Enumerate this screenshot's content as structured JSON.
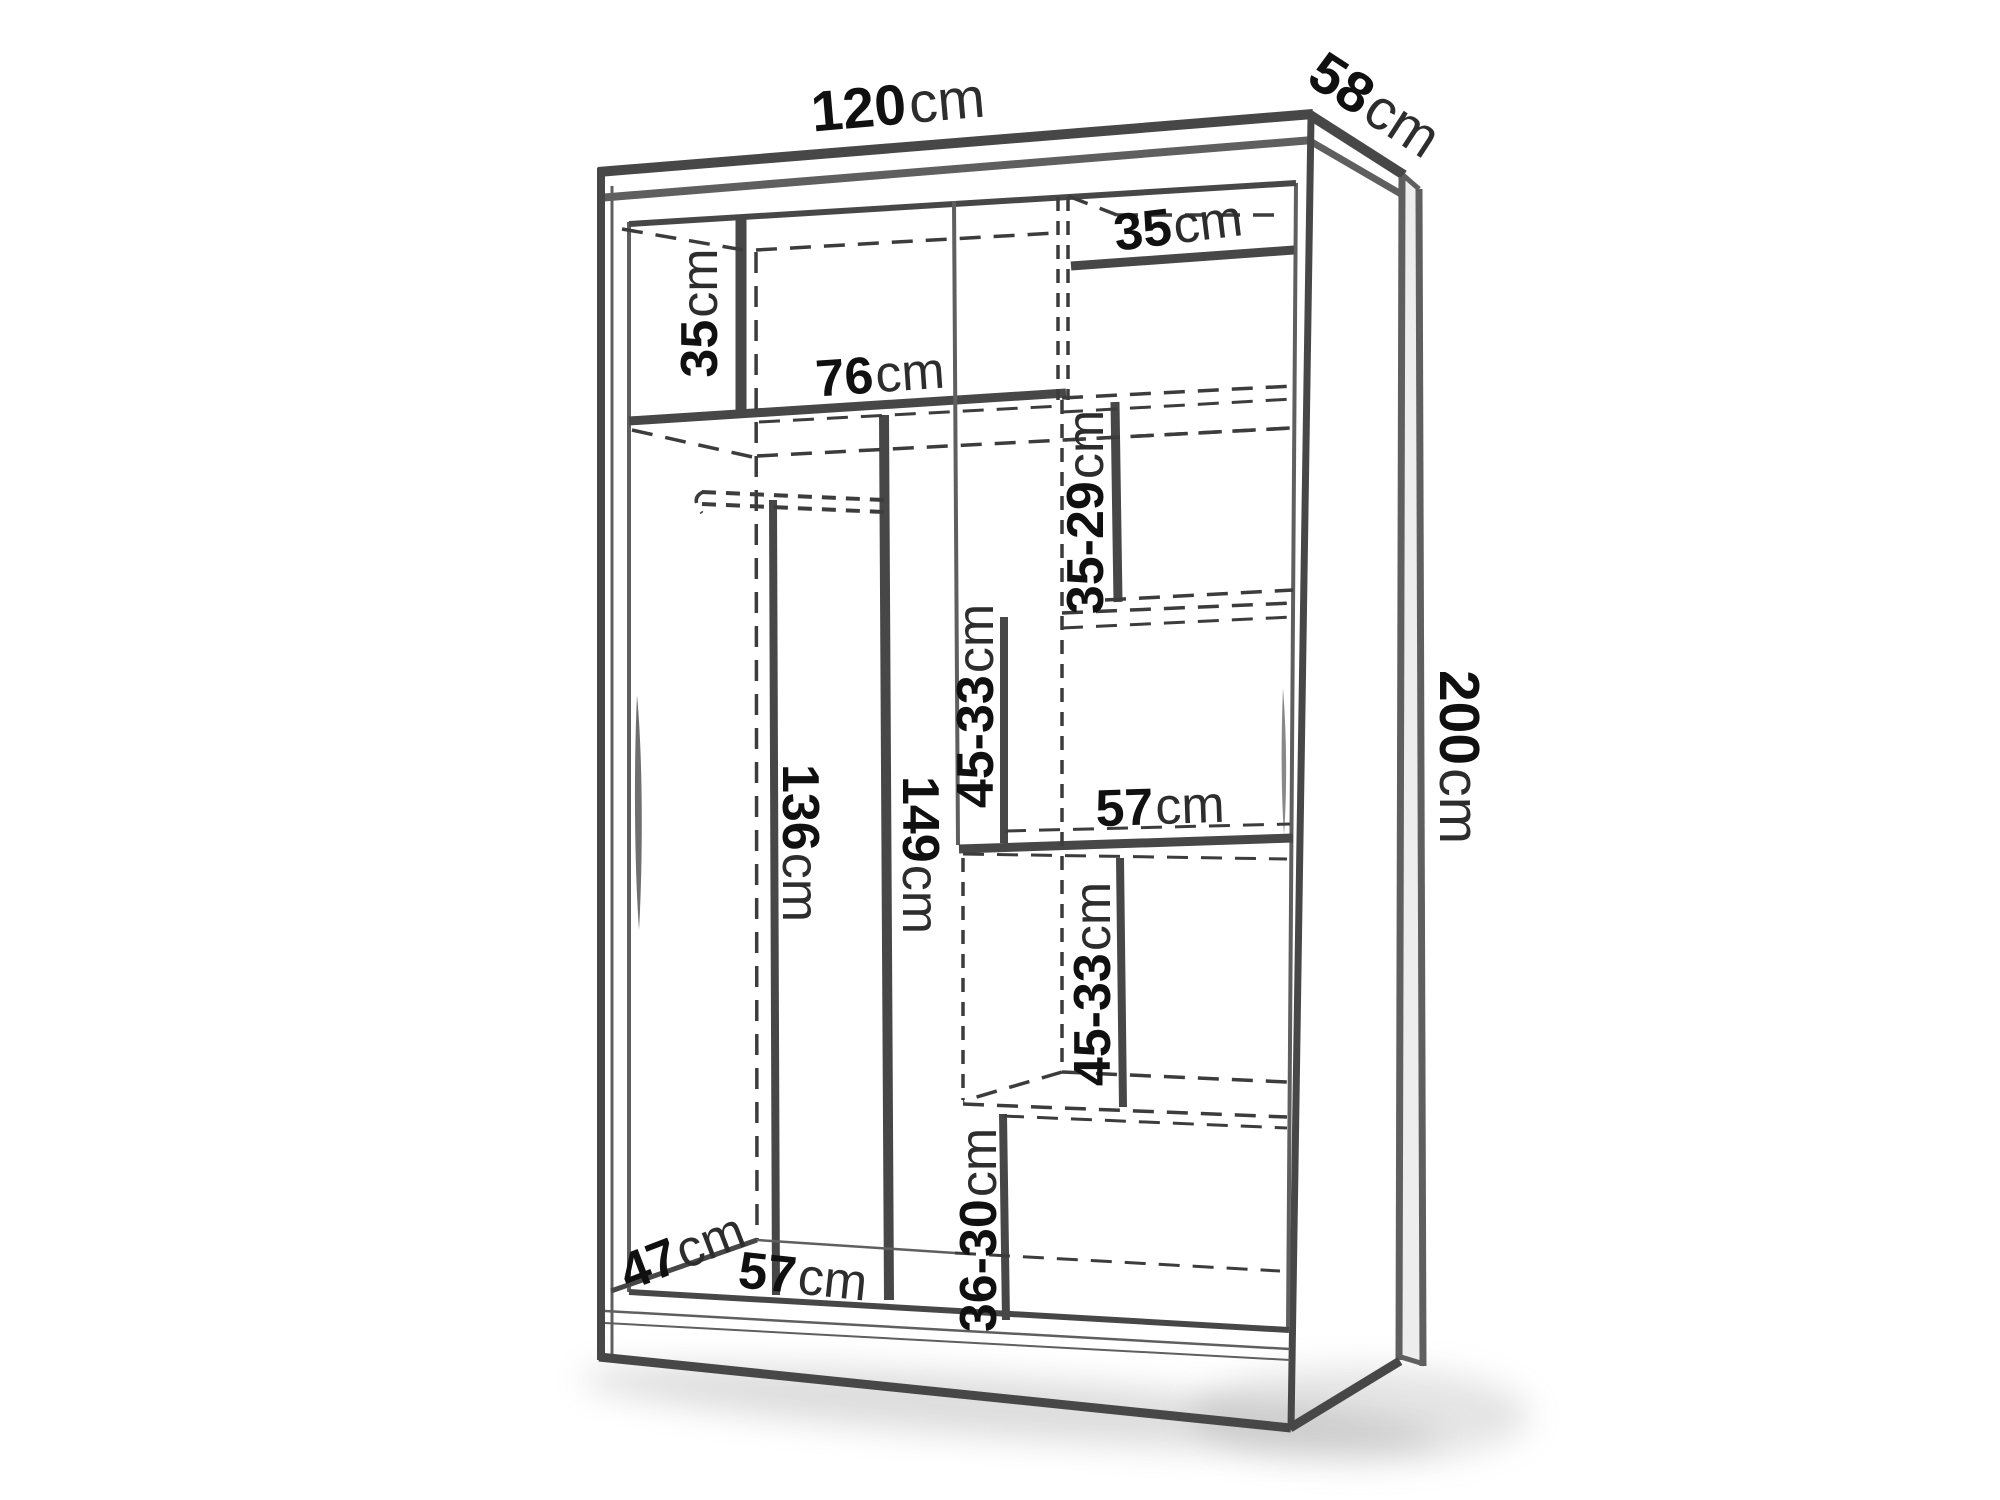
{
  "diagram": {
    "title": "wardrobe-dimension-drawing",
    "background_color": "#ffffff",
    "line_color": "#474747",
    "dashed_line_color": "#3c3c3c",
    "text_color": "#141414",
    "unit": "cm",
    "labels": {
      "width_top": {
        "num": "120",
        "unit": "cm"
      },
      "depth_top": {
        "num": "58",
        "unit": "cm"
      },
      "height_right": {
        "num": "200",
        "unit": "cm"
      },
      "upper_left_shelf": {
        "num": "35",
        "unit": "cm"
      },
      "left_section_width": {
        "num": "76",
        "unit": "cm"
      },
      "upper_right_shelf": {
        "num": "35",
        "unit": "cm"
      },
      "right_upper_compartment": {
        "num": "35-29",
        "unit": "cm"
      },
      "middle_compartment": {
        "num": "45-33",
        "unit": "cm"
      },
      "hanging_height": {
        "num": "136",
        "unit": "cm"
      },
      "left_section_height": {
        "num": "149",
        "unit": "cm"
      },
      "right_middle_shelf": {
        "num": "57",
        "unit": "cm"
      },
      "right_lower_compartment": {
        "num": "45-33",
        "unit": "cm"
      },
      "bottom_compartment": {
        "num": "36-30",
        "unit": "cm"
      },
      "bottom_depth": {
        "num": "47",
        "unit": "cm"
      },
      "bottom_shelf_width": {
        "num": "57",
        "unit": "cm"
      }
    }
  }
}
